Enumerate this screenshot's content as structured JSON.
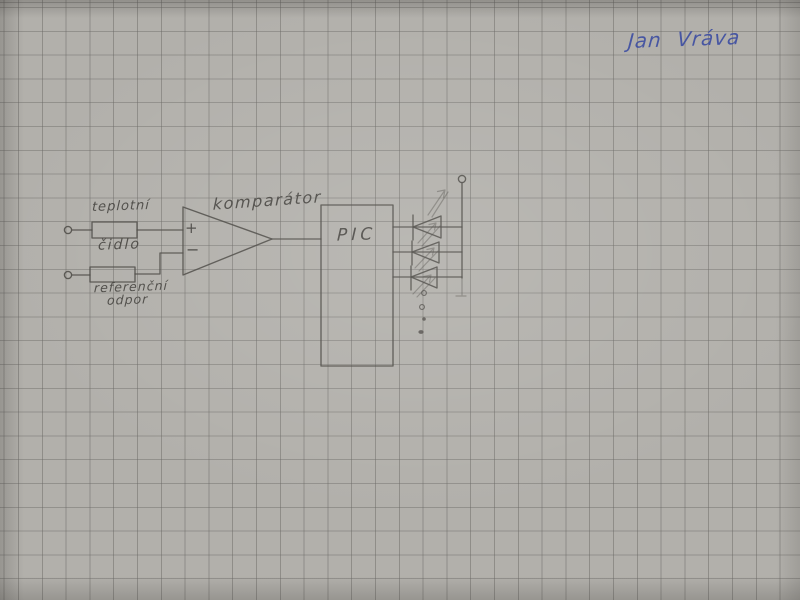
{
  "photo": {
    "description": "hand-drawn circuit schematic in pencil on gray squared graph paper",
    "colors": {
      "paper": "#b2b0ab",
      "grid_line": "#8f8d8a",
      "pencil": "#4c4a46",
      "blue_ink": "#3f4fa2"
    }
  },
  "signature": {
    "text": "Jan Vráva"
  },
  "schematic": {
    "labels": {
      "sensor_line1": "teplotní",
      "sensor_line2": "čidlo",
      "reference_line1": "referenční",
      "reference_line2": "odpor",
      "comparator": "komparátor",
      "mcu": "PIC",
      "plus": "+",
      "minus": "−"
    },
    "components": [
      {
        "type": "input-terminal",
        "label": ""
      },
      {
        "type": "resistor",
        "label": "teplotní čidlo"
      },
      {
        "type": "input-terminal",
        "label": ""
      },
      {
        "type": "resistor",
        "label": "referenční odpor"
      },
      {
        "type": "comparator",
        "label": "komparátor",
        "inputs": [
          "+",
          "−"
        ]
      },
      {
        "type": "microcontroller",
        "label": "PIC"
      },
      {
        "type": "led",
        "count": 3
      },
      {
        "type": "supply-terminal",
        "label": ""
      },
      {
        "type": "continuation-dots",
        "count": 4
      }
    ]
  }
}
